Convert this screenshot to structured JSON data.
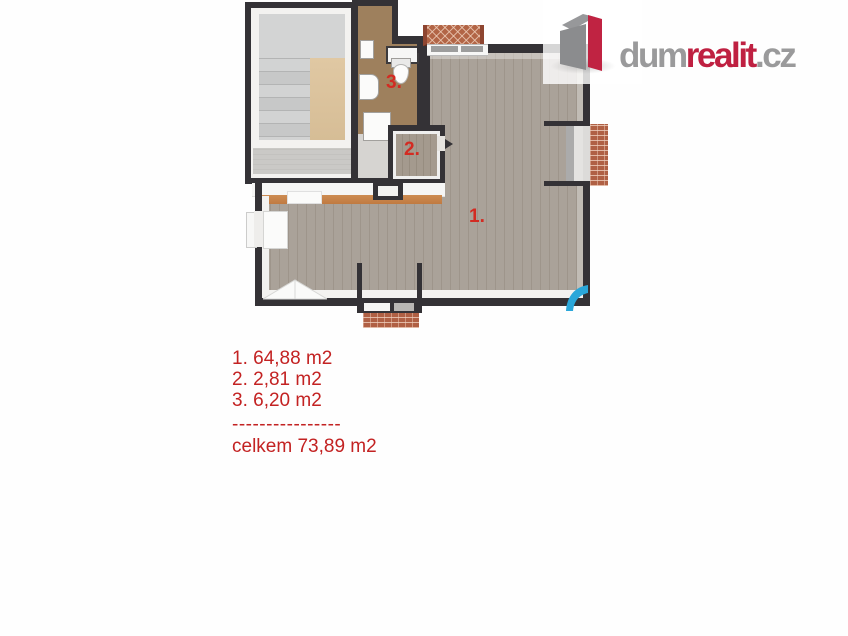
{
  "logo": {
    "icon": "dumrealit-cube-icon",
    "text_part1": "dum",
    "text_part2": "realit",
    "text_part3": ".cz",
    "colors": {
      "gray": "#9a9a9b",
      "red": "#bf2041"
    }
  },
  "floorplan": {
    "rooms": [
      {
        "number": "1.",
        "name": "main-room"
      },
      {
        "number": "2.",
        "name": "small-room"
      },
      {
        "number": "3.",
        "name": "bathroom"
      }
    ],
    "label_color": "#d32b22",
    "colors": {
      "wall": "#343236",
      "main_floor": "#aaa299",
      "bathroom_floor": "#9e805d",
      "stair_landing": "#d3d4d4",
      "stair_side_floor": "#dcc49e",
      "corridor_floor": "#cac9c6",
      "brick": "#b26546",
      "accent_strip": "#c98a4e"
    }
  },
  "legend": {
    "lines": [
      "1. 64,88 m2",
      "2. 2,81 m2",
      "3. 6,20 m2"
    ],
    "divider": "----------------",
    "total": "celkem 73,89 m2",
    "color": "#c32222"
  },
  "watermark": {
    "icon": "blue-swoosh-icon",
    "color": "#2aa7da"
  }
}
